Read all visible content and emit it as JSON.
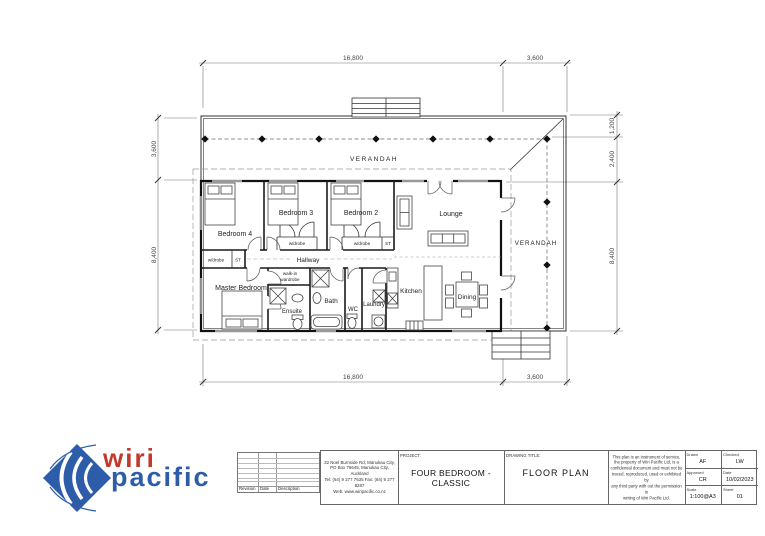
{
  "plan": {
    "dim_top_main": "16,800",
    "dim_top_right": "3,600",
    "dim_bottom_main": "16,800",
    "dim_bottom_right": "3,600",
    "dim_left_top": "3,600",
    "dim_left_main": "8,400",
    "dim_right_1": "1,200",
    "dim_right_2": "2,400",
    "dim_right_3": "8,400",
    "verandah_top": "VERANDAH",
    "verandah_right": "VERANDAH",
    "lounge": "Lounge",
    "bedroom2": "Bedroom 2",
    "bedroom3": "Bedroom 3",
    "bedroom4": "Bedroom 4",
    "master_bedroom": "Master Bedroom",
    "hallway": "Hallway",
    "kitchen": "Kitchen",
    "dining": "Dining",
    "bath": "Bath",
    "wc": "WC",
    "laundry": "Laundry",
    "ensuite": "Ensuite",
    "walk_in_line1": "walk-in",
    "walk_in_line2": "wardrobe",
    "wardrobe_b3": "w/drobe",
    "wardrobe_b2": "w/drobe",
    "wardrobe_master": "w/drobe",
    "st_b2": "ST",
    "st_master": "ST"
  },
  "title_block": {
    "logo": {
      "word1": "wiri",
      "word2": "pacific"
    },
    "revision_table": {
      "col1": "Revision",
      "col2": "Date",
      "col3": "Description"
    },
    "address_lines": [
      "32 Noel Burnside Rd, Manukau City,",
      "PO Box 76645, Manukau City, Auckland",
      "Tel: (64) 9 277 7635  Fax: (64) 9 277 8287",
      "Web: www.wiripacific.co.nz"
    ],
    "project_label": "PROJECT:",
    "project_value": "FOUR BEDROOM - CLASSIC",
    "drawing_title_label": "DRAWING TITLE:",
    "drawing_title_value": "FLOOR PLAN",
    "disclaimer_lines": [
      "This plan is an instrument of service,",
      "the property of Wiri Pacific Ltd, is a",
      "confidential document and must not be",
      "traced, reproduced, used or exhibited by",
      "any third party with out the permission in",
      "writing of Wiri Pacific Ltd."
    ],
    "fields": {
      "drawn_label": "Drawn",
      "drawn_value": "AF",
      "checked_label": "Checked",
      "checked_value": "LW",
      "approved_label": "Approved",
      "approved_value": "CR",
      "date_label": "Date",
      "date_value": "10/02/2023",
      "scale_label": "Scale",
      "scale_value": "1:100@A3",
      "sheet_label": "Sheet",
      "sheet_value": "01"
    }
  }
}
